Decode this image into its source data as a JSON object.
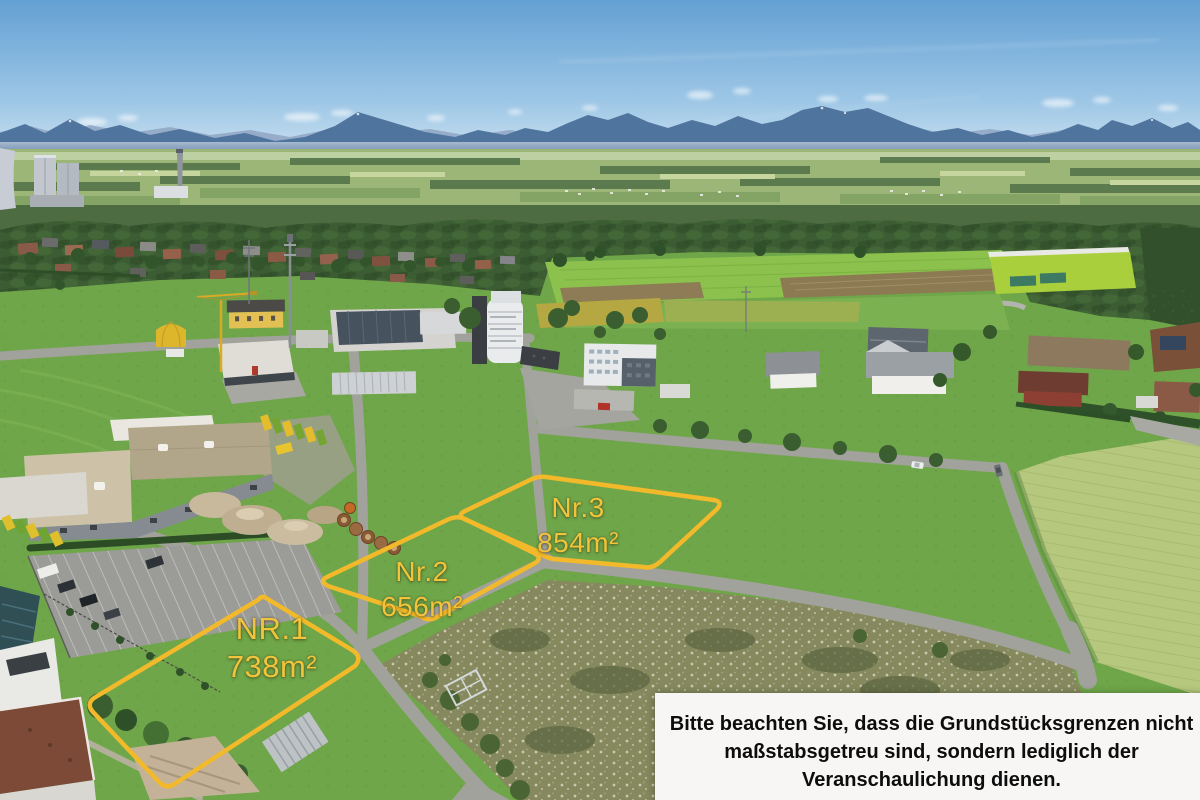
{
  "photo": {
    "description": "Aerial drone photo of building plots for sale in an alpine-foreland commercial area",
    "plots": [
      {
        "id": "nr1",
        "label": "NR.1",
        "area": "738m²"
      },
      {
        "id": "nr2",
        "label": "Nr.2",
        "area": "656m²"
      },
      {
        "id": "nr3",
        "label": "Nr.3",
        "area": "854m²"
      }
    ],
    "disclaimer": {
      "line1": "Bitte beachten Sie, dass die Grundstücksgrenzen nicht",
      "line2": "maßstabsgetreu sind, sondern lediglich der",
      "line3": "Veranschaulichung dienen."
    },
    "colors": {
      "plot_outline": "#F2B92B",
      "plot_label": "#F2C43B",
      "disclaimer_bg": "#F7F6F4",
      "disclaimer_text": "#0D0D0D"
    }
  }
}
